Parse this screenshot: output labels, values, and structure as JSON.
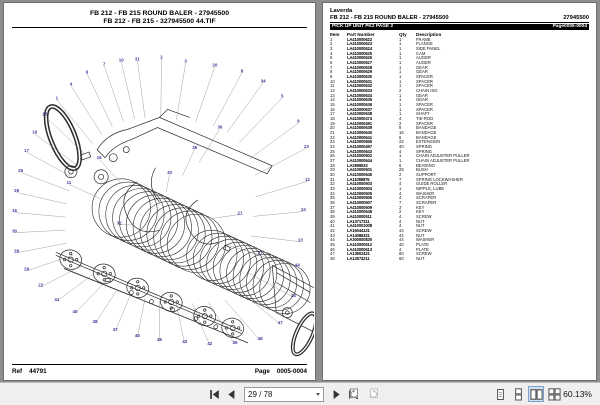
{
  "left_page": {
    "title_line1": "FB 212 - FB 215  ROUND BALER - 27945500",
    "title_line2": "FB 212 - FB 215 - 327945500 44.TIF",
    "footer": {
      "ref_label": "Ref",
      "ref_value": "44791",
      "page_label": "Page",
      "page_value": "0005-0004"
    }
  },
  "right_page": {
    "brand": "Laverda",
    "title": "FB 212 - FB 215  ROUND BALER - 27945500",
    "code": "27945500",
    "section": "PICK UP UNIT PK2 PAGE 2",
    "section_page": "Page0005-0004",
    "table": {
      "headers": [
        "Item",
        "Part Number",
        "Qty",
        "Description"
      ],
      "rows": [
        [
          "1",
          "LA410000622",
          "1",
          "FRAME"
        ],
        [
          "2",
          "LA410000623",
          "1",
          "FLANGE"
        ],
        [
          "3",
          "LA410000624",
          "1",
          "SIDE PANEL"
        ],
        [
          "4",
          "LA410000625",
          "1",
          "CAM"
        ],
        [
          "5",
          "LA410000626",
          "1",
          "AUGER"
        ],
        [
          "6",
          "LA410000627",
          "1",
          "AUGER"
        ],
        [
          "7",
          "LA410000628",
          "1",
          "GEAR"
        ],
        [
          "8",
          "LA410000629",
          "1",
          "GEAR"
        ],
        [
          "9",
          "LA410000630",
          "1",
          "SPACER"
        ],
        [
          "10",
          "LA410000631",
          "1",
          "SPACER"
        ],
        [
          "11",
          "LA410000632",
          "1",
          "SPACER"
        ],
        [
          "12",
          "LA410000633",
          "2",
          "CHAIN ISO"
        ],
        [
          "13",
          "LA410000634",
          "1",
          "GEAR"
        ],
        [
          "14",
          "LA410000635",
          "1",
          "GEAR"
        ],
        [
          "15",
          "LA410000636",
          "1",
          "SPACER"
        ],
        [
          "16",
          "LA410000637",
          "1",
          "SPACER"
        ],
        [
          "17",
          "LA410000638",
          "1",
          "SHAFT"
        ],
        [
          "18",
          "LA410000474",
          "4",
          "TIE-ROD"
        ],
        [
          "19",
          "LA410000491",
          "2",
          "SPACER"
        ],
        [
          "20",
          "LA410000639",
          "8",
          "BANDAGE"
        ],
        [
          "21",
          "LA410000640",
          "16",
          "BANDAGE"
        ],
        [
          "22",
          "LA410000641",
          "6",
          "BANDAGE"
        ],
        [
          "23",
          "LA410000655",
          "22",
          "EXTENSION"
        ],
        [
          "24",
          "LA410000497",
          "40",
          "SPRING"
        ],
        [
          "25",
          "LA410000643",
          "4",
          "SPRING"
        ],
        [
          "26",
          "LA410000502",
          "1",
          "CHAIN ADJUSTER PULLER"
        ],
        [
          "27",
          "LA410000644",
          "1",
          "CHAIN ADJUSTER PULLER"
        ],
        [
          "28",
          "LA2699533",
          "6",
          "BEARING"
        ],
        [
          "29",
          "LA410000501",
          "28",
          "BUSH"
        ],
        [
          "30",
          "LA410000645",
          "2",
          "SUPPORT"
        ],
        [
          "31",
          "LA11088876",
          "7",
          "SPRING LOCKWASHER"
        ],
        [
          "32",
          "LA410000503",
          "4",
          "GUIDE ROLLER"
        ],
        [
          "33",
          "LA410000504",
          "1",
          "NIPPLE, LUBE"
        ],
        [
          "34",
          "LA410000505",
          "4",
          "WASHER"
        ],
        [
          "35",
          "LA410000506",
          "4",
          "SCRAPER"
        ],
        [
          "36",
          "LA410000507",
          "7",
          "SCRAPER"
        ],
        [
          "37",
          "LA410000509",
          "3",
          "KEY"
        ],
        [
          "38",
          "LA410000648",
          "2",
          "KEY"
        ],
        [
          "39",
          "LA410000511",
          "4",
          "SCREW"
        ],
        [
          "40",
          "LA13717311",
          "4",
          "NUT"
        ],
        [
          "41",
          "LA410001008",
          "4",
          "NUT"
        ],
        [
          "42",
          "LA16044121",
          "44",
          "SCREW"
        ],
        [
          "43",
          "LA14086321",
          "44",
          "NUT"
        ],
        [
          "44",
          "LA300000830",
          "44",
          "WASHER"
        ],
        [
          "45",
          "LA410000612",
          "40",
          "PLATE"
        ],
        [
          "46",
          "LA410000613",
          "4",
          "PLATE"
        ],
        [
          "47",
          "LA13902421",
          "60",
          "SCREW"
        ],
        [
          "48",
          "LA12574211",
          "60",
          "NUT"
        ]
      ]
    }
  },
  "diagram": {
    "callout_color": "#3b3b9a",
    "leader_color": "#777777",
    "callouts": [
      {
        "n": "31",
        "x": 128,
        "y": 10
      },
      {
        "n": "2",
        "x": 152,
        "y": 8
      },
      {
        "n": "3",
        "x": 176,
        "y": 12
      },
      {
        "n": "20",
        "x": 205,
        "y": 16
      },
      {
        "n": "8",
        "x": 232,
        "y": 22
      },
      {
        "n": "34",
        "x": 253,
        "y": 32
      },
      {
        "n": "5",
        "x": 272,
        "y": 47
      },
      {
        "n": "9",
        "x": 288,
        "y": 72
      },
      {
        "n": "23",
        "x": 296,
        "y": 97
      },
      {
        "n": "12",
        "x": 297,
        "y": 130
      },
      {
        "n": "24",
        "x": 293,
        "y": 160
      },
      {
        "n": "13",
        "x": 290,
        "y": 190
      },
      {
        "n": "44",
        "x": 287,
        "y": 215
      },
      {
        "n": "14",
        "x": 283,
        "y": 245
      },
      {
        "n": "47",
        "x": 270,
        "y": 272
      },
      {
        "n": "48",
        "x": 250,
        "y": 288
      },
      {
        "n": "39",
        "x": 225,
        "y": 292
      },
      {
        "n": "42",
        "x": 200,
        "y": 293
      },
      {
        "n": "43",
        "x": 175,
        "y": 291
      },
      {
        "n": "45",
        "x": 150,
        "y": 289
      },
      {
        "n": "46",
        "x": 128,
        "y": 285
      },
      {
        "n": "37",
        "x": 106,
        "y": 279
      },
      {
        "n": "38",
        "x": 86,
        "y": 271
      },
      {
        "n": "40",
        "x": 66,
        "y": 261
      },
      {
        "n": "41",
        "x": 48,
        "y": 249
      },
      {
        "n": "22",
        "x": 32,
        "y": 235
      },
      {
        "n": "29",
        "x": 18,
        "y": 219
      },
      {
        "n": "28",
        "x": 8,
        "y": 201
      },
      {
        "n": "30",
        "x": 6,
        "y": 181
      },
      {
        "n": "16",
        "x": 6,
        "y": 161
      },
      {
        "n": "26",
        "x": 8,
        "y": 141
      },
      {
        "n": "25",
        "x": 12,
        "y": 121
      },
      {
        "n": "17",
        "x": 18,
        "y": 101
      },
      {
        "n": "19",
        "x": 26,
        "y": 83
      },
      {
        "n": "18",
        "x": 36,
        "y": 65
      },
      {
        "n": "1",
        "x": 48,
        "y": 49
      },
      {
        "n": "4",
        "x": 62,
        "y": 35
      },
      {
        "n": "6",
        "x": 78,
        "y": 23
      },
      {
        "n": "7",
        "x": 95,
        "y": 15
      },
      {
        "n": "10",
        "x": 112,
        "y": 11
      },
      {
        "n": "11",
        "x": 60,
        "y": 133
      },
      {
        "n": "15",
        "x": 90,
        "y": 108
      },
      {
        "n": "21",
        "x": 230,
        "y": 163
      },
      {
        "n": "27",
        "x": 250,
        "y": 203
      },
      {
        "n": "32",
        "x": 110,
        "y": 173
      },
      {
        "n": "33",
        "x": 160,
        "y": 123
      },
      {
        "n": "35",
        "x": 185,
        "y": 98
      },
      {
        "n": "36",
        "x": 210,
        "y": 78
      }
    ]
  },
  "toolbar": {
    "page_value": "29 / 78",
    "zoom_level": "60.13%",
    "icons": [
      "first-page",
      "previous-page",
      "page-number-combobox",
      "next-page",
      "last-page",
      "previous-view",
      "next-view",
      "single-page-layout",
      "one-column-layout",
      "two-page-layout",
      "two-column-layout"
    ]
  }
}
